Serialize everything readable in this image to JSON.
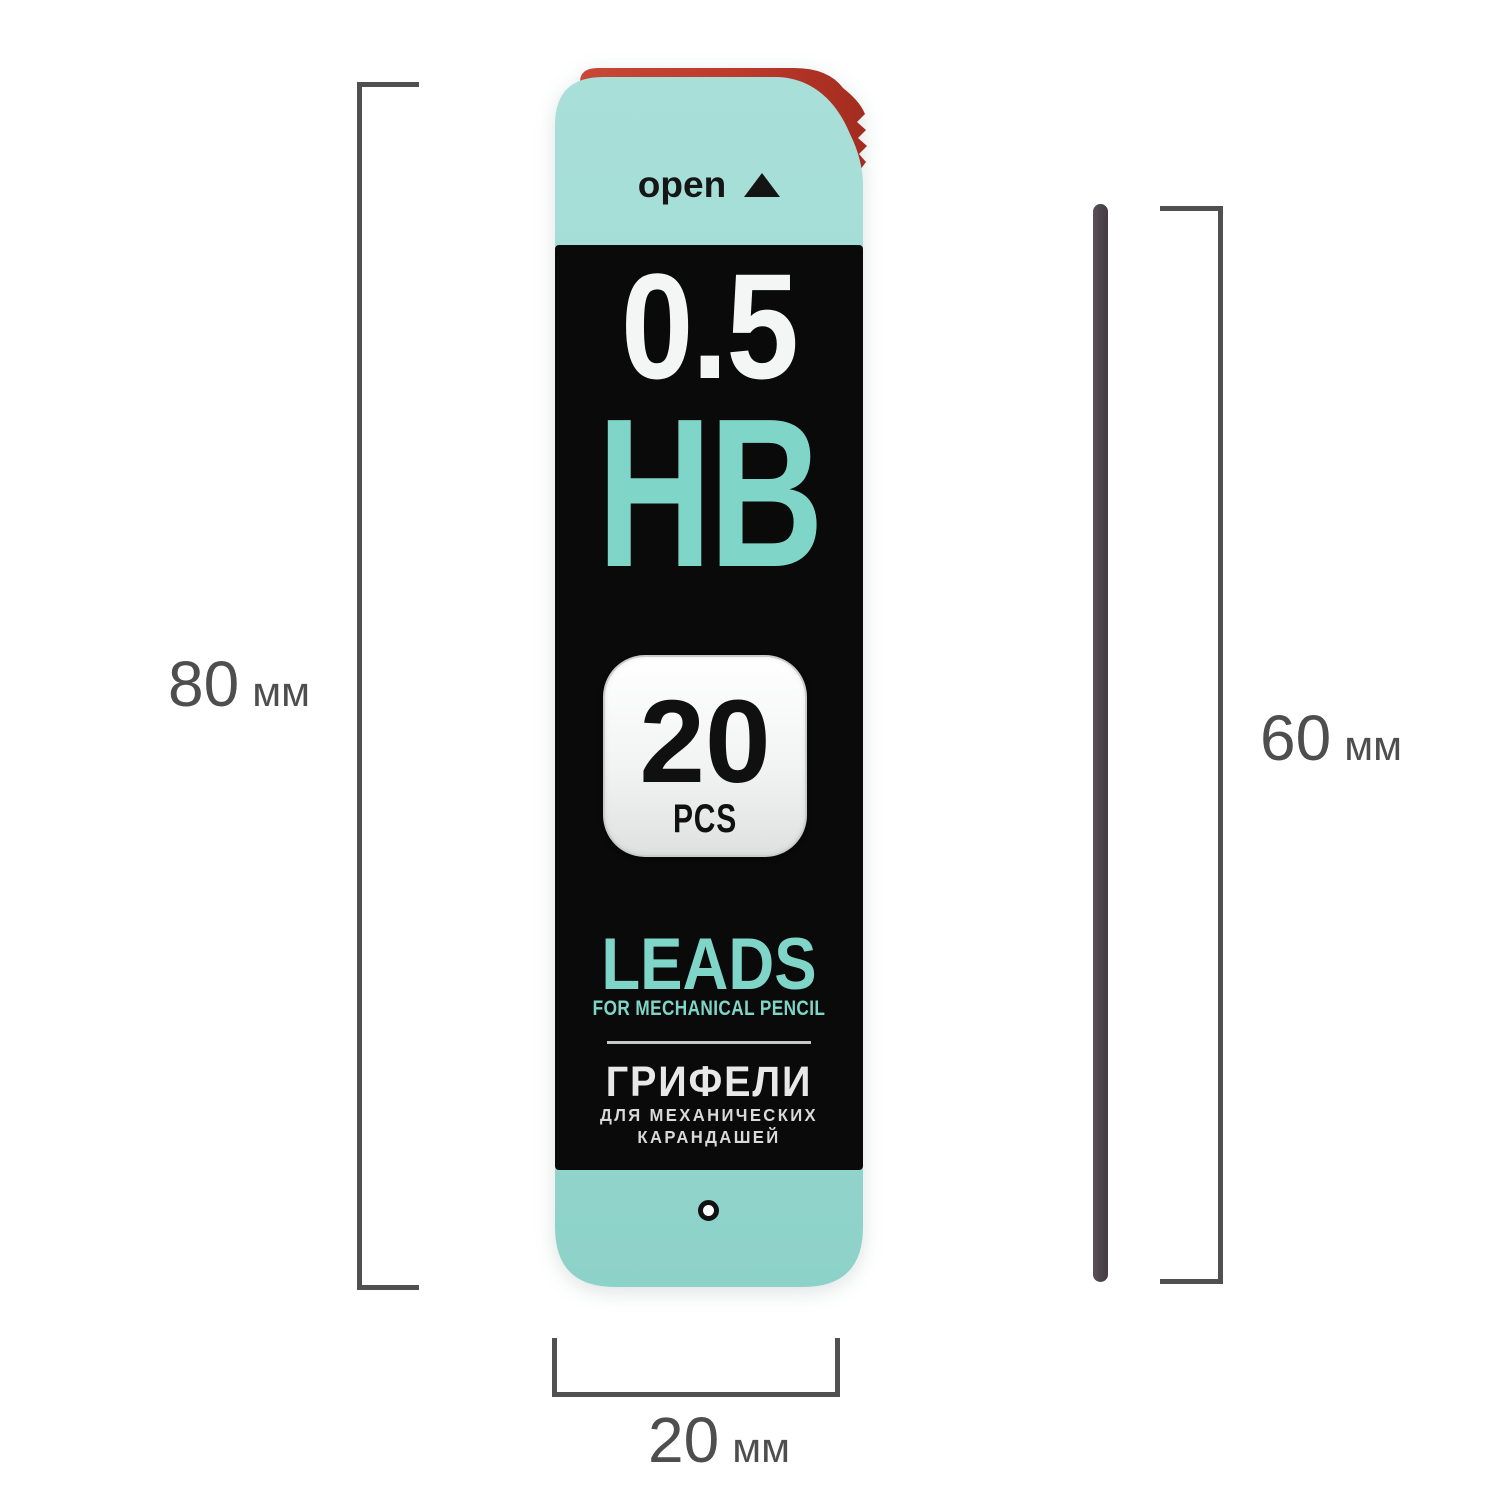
{
  "package": {
    "open_label": "open",
    "lead_diameter": "0.5",
    "hardness": "HB",
    "count": "20",
    "count_unit": "PCS",
    "name_en": "LEADS",
    "subtitle_en": "FOR MECHANICAL PENCIL",
    "name_ru": "ГРИФЕЛИ",
    "subtitle_ru_line1": "ДЛЯ МЕХАНИЧЕСКИХ",
    "subtitle_ru_line2": "КАРАНДАШЕЙ",
    "colors": {
      "body_teal": "#9fdad3",
      "accent_teal": "#7fd6c8",
      "cap_red": "#bd3a2b",
      "label_black": "#0a0a0a",
      "count_box_white": "#f2f3f3"
    }
  },
  "lead_stick": {
    "color": "#4e444b"
  },
  "dimensions": {
    "package_height": {
      "value": "80",
      "unit": "мм"
    },
    "lead_length": {
      "value": "60",
      "unit": "мм"
    },
    "package_width": {
      "value": "20",
      "unit": "мм"
    },
    "line_color": "#505050",
    "text_color": "#4e4e4e"
  },
  "icons": {
    "open_direction_icon": "▲",
    "hang_hole_icon": "◦"
  }
}
